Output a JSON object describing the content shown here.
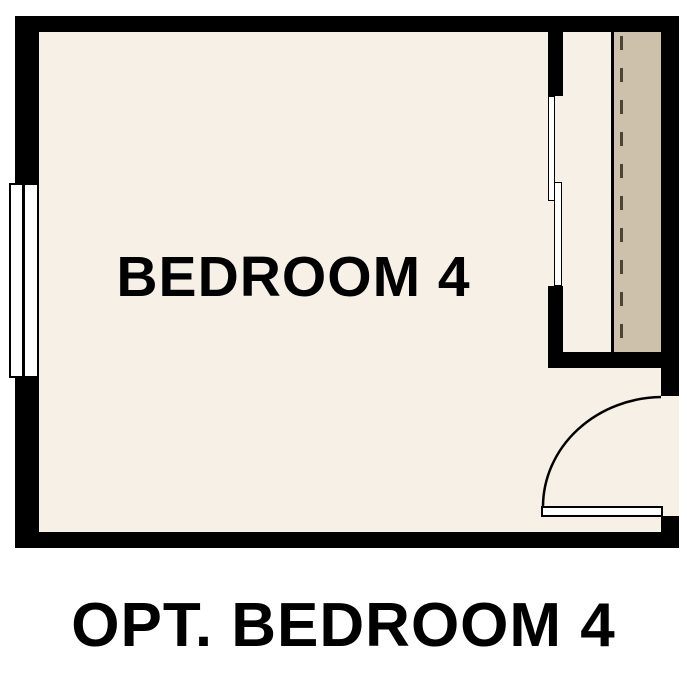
{
  "plan": {
    "room_label": "BEDROOM 4",
    "caption": "OPT. BEDROOM 4",
    "colors": {
      "wall": "#000000",
      "floor": "#f7f0e6",
      "wardrobe": "#cdc1ab",
      "background": "#ffffff",
      "text": "#000000",
      "line": "#4b4437"
    }
  }
}
